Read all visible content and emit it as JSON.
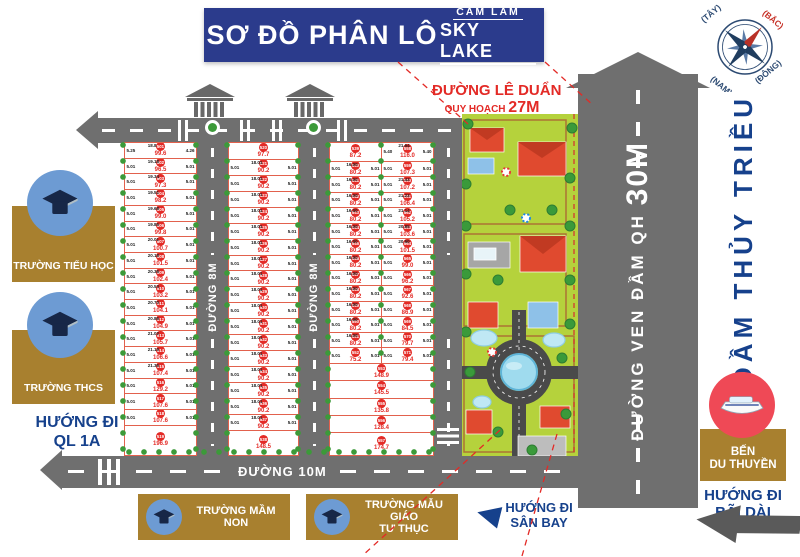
{
  "title": {
    "main": "SƠ ĐỒ PHÂN LÔ",
    "brand_top": "CAM LÂM",
    "brand_bottom": "SKY LAKE"
  },
  "compass": {
    "n": "(BẮC)",
    "e": "(ĐÔNG)",
    "s": "(NAM)",
    "w": "(TÂY)"
  },
  "roads": {
    "le_duan": "ĐƯỜNG LÊ DUẨN",
    "le_duan_sub": "QUY HOẠCH ",
    "le_duan_size": "27M",
    "r8": "ĐƯỜNG 8M",
    "r10": "ĐƯỜNG 10M",
    "ven_dam": "ĐƯỜNG VEN ĐẦM QH ",
    "ven_dam_size": "30M"
  },
  "sidebar": {
    "primary": "TRƯỜNG TIỂU HỌC",
    "secondary": "TRƯỜNG THCS",
    "ql1a_1": "HƯỚNG ĐI",
    "ql1a_2": "QL 1A"
  },
  "bottom": {
    "kg": "TRƯỜNG MẦM NON",
    "pkg1": "TRƯỜNG MẪU GIÁO",
    "pkg2": "TƯ THỤC",
    "airport1": "HƯỚNG ĐI",
    "airport2": "SÂN BAY"
  },
  "right": {
    "lagoon": "ĐẦM THỦY TRIỀU",
    "marina1": "BẾN",
    "marina2": "DU THUYỀN",
    "baidai1": "HƯỚNG ĐI",
    "baidai2": "BÃI DÀI"
  },
  "colors": {
    "banner": "#2b3b8c",
    "accent_red": "#e32a26",
    "road_gray": "#6f6f6f",
    "card_brown": "#a8802f",
    "text_blue": "#16418c",
    "resort_green": "#b5d23c",
    "plot_border": "#e2614d"
  },
  "blocks": {
    "a": [
      {
        "n": "501",
        "a": "99.6",
        "d": "18.8",
        "sl": "5.25",
        "sr": "4.26"
      },
      {
        "n": "502",
        "a": "96.5",
        "d": "19.18",
        "s": "5.01"
      },
      {
        "n": "503",
        "a": "97.3",
        "d": "19.34",
        "s": "5.01"
      },
      {
        "n": "504",
        "a": "98.2",
        "d": "19.51",
        "s": "5.01"
      },
      {
        "n": "505",
        "a": "99.0",
        "d": "19.68",
        "s": "5.01"
      },
      {
        "n": "506",
        "a": "99.8",
        "d": "19.85",
        "s": "5.01"
      },
      {
        "n": "507",
        "a": "100.7",
        "d": "20.01",
        "s": "5.01"
      },
      {
        "n": "508",
        "a": "101.5",
        "d": "20.18",
        "s": "5.01"
      },
      {
        "n": "509",
        "a": "102.4",
        "d": "20.36",
        "s": "5.01"
      },
      {
        "n": "510",
        "a": "103.2",
        "d": "20.53",
        "s": "5.01"
      },
      {
        "n": "511",
        "a": "104.1",
        "d": "20.70",
        "s": "5.01"
      },
      {
        "n": "512",
        "a": "104.9",
        "d": "20.86",
        "s": "5.01"
      },
      {
        "n": "513",
        "a": "105.7",
        "d": "21.02",
        "s": "5.01"
      },
      {
        "n": "514",
        "a": "106.6",
        "d": "21.19",
        "s": "5.01"
      },
      {
        "n": "515",
        "a": "107.4",
        "d": "21.36",
        "s": "5.01"
      },
      {
        "n": "516",
        "a": "129.2",
        "s": "5.01"
      },
      {
        "n": "517",
        "a": "107.6",
        "s": "5.01"
      },
      {
        "n": "518",
        "a": "107.6",
        "s": "5.01"
      },
      {
        "n": "519",
        "a": "196.9",
        "f": 2
      }
    ],
    "b": [
      {
        "n": "520",
        "a": "97.7",
        "f": 1.05
      },
      {
        "n": "521",
        "a": "90.2",
        "d": "18.01",
        "s": "5.01"
      },
      {
        "n": "522",
        "a": "90.2",
        "d": "18.01",
        "s": "5.01"
      },
      {
        "n": "523",
        "a": "90.2",
        "d": "18.01",
        "s": "5.01"
      },
      {
        "n": "524",
        "a": "90.2",
        "d": "18.01",
        "s": "5.01"
      },
      {
        "n": "525",
        "a": "90.2",
        "d": "18.01",
        "s": "5.01"
      },
      {
        "n": "526",
        "a": "90.2",
        "d": "18.01",
        "s": "5.01"
      },
      {
        "n": "527",
        "a": "90.2",
        "d": "18.01",
        "s": "5.01"
      },
      {
        "n": "528",
        "a": "90.2",
        "d": "18.01",
        "s": "5.01"
      },
      {
        "n": "529",
        "a": "90.2",
        "d": "18.01",
        "s": "5.01"
      },
      {
        "n": "530",
        "a": "90.2",
        "d": "18.01",
        "s": "5.01"
      },
      {
        "n": "531",
        "a": "90.2",
        "d": "18.01",
        "s": "5.01"
      },
      {
        "n": "532",
        "a": "90.2",
        "d": "18.01",
        "s": "5.01"
      },
      {
        "n": "533",
        "a": "90.2",
        "d": "18.01",
        "s": "5.01"
      },
      {
        "n": "534",
        "a": "90.2",
        "d": "18.01",
        "s": "5.01"
      },
      {
        "n": "535",
        "a": "90.2",
        "d": "18.01",
        "s": "5.01"
      },
      {
        "n": "536",
        "a": "90.2",
        "d": "18.01",
        "s": "5.01"
      },
      {
        "n": "537",
        "a": "90.2",
        "d": "18.01",
        "s": "5.01"
      },
      {
        "n": "538",
        "a": "148.5",
        "f": 1.6
      }
    ],
    "c_left": [
      {
        "n": "539",
        "a": "87.2",
        "f": 1.2
      },
      {
        "n": "540",
        "a": "80.2",
        "d": "16.00",
        "s": "5.01"
      },
      {
        "n": "541",
        "a": "80.2",
        "d": "16.00",
        "s": "5.01"
      },
      {
        "n": "542",
        "a": "80.2",
        "d": "16.00",
        "s": "5.01"
      },
      {
        "n": "543",
        "a": "80.2",
        "d": "16.00",
        "s": "5.01"
      },
      {
        "n": "544",
        "a": "80.2",
        "d": "16.00",
        "s": "5.01"
      },
      {
        "n": "545",
        "a": "80.2",
        "d": "16.00",
        "s": "5.01"
      },
      {
        "n": "546",
        "a": "80.2",
        "d": "16.00",
        "s": "5.01"
      },
      {
        "n": "547",
        "a": "80.2",
        "d": "16.00",
        "s": "5.01"
      },
      {
        "n": "548",
        "a": "80.2",
        "d": "16.00",
        "s": "5.01"
      },
      {
        "n": "549",
        "a": "80.2",
        "d": "16.00",
        "s": "5.01"
      },
      {
        "n": "550",
        "a": "80.2",
        "d": "16.00",
        "s": "5.01"
      },
      {
        "n": "551",
        "a": "80.2",
        "d": "16.00",
        "s": "5.01"
      },
      {
        "n": "552",
        "a": "75.2",
        "s": "5.01"
      }
    ],
    "c_right": [
      {
        "n": "558",
        "a": "116.0",
        "d": "21.64",
        "s": "5.40",
        "f": 1.2
      },
      {
        "n": "559",
        "a": "107.3",
        "s": "5.01"
      },
      {
        "n": "560",
        "a": "107.2",
        "d": "21.43",
        "s": "5.01"
      },
      {
        "n": "561",
        "a": "106.4",
        "d": "21.23",
        "s": "5.01"
      },
      {
        "n": "562",
        "a": "105.2",
        "d": "21.14",
        "s": "5.01"
      },
      {
        "n": "563",
        "a": "103.6",
        "d": "20.85",
        "s": "5.01"
      },
      {
        "n": "564",
        "a": "101.5",
        "d": "20.50",
        "s": "5.01"
      },
      {
        "n": "565",
        "a": "99.0",
        "s": "5.01"
      },
      {
        "n": "566",
        "a": "96.2",
        "s": "5.01"
      },
      {
        "n": "567",
        "a": "92.6",
        "s": "5.01"
      },
      {
        "n": "568",
        "a": "86.9",
        "s": "5.01"
      },
      {
        "n": "569",
        "a": "84.5",
        "s": "5.01"
      },
      {
        "n": "570",
        "a": "79.7",
        "s": "5.01"
      },
      {
        "n": "571",
        "a": "79.4",
        "s": "5.01"
      }
    ],
    "c_bottom": [
      {
        "n": "553",
        "a": "148.9"
      },
      {
        "n": "554",
        "a": "145.5"
      },
      {
        "n": "555",
        "a": "135.8"
      },
      {
        "n": "556",
        "a": "128.4"
      },
      {
        "n": "557",
        "a": "174.7",
        "f": 1.35
      }
    ]
  }
}
